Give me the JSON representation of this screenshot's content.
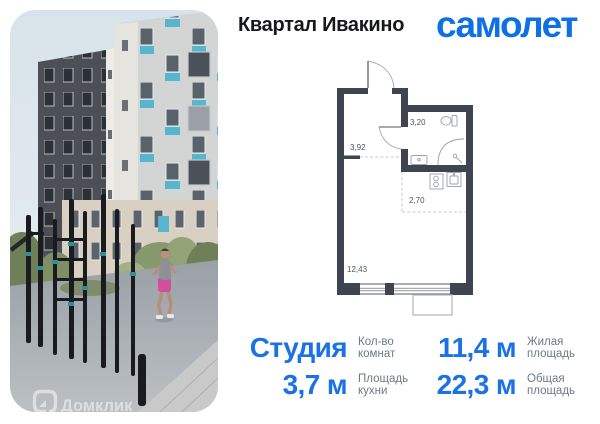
{
  "header": {
    "project_title": "Квартал Ивакино",
    "brand_logo": "самолет"
  },
  "photo": {
    "watermark": "Домклик",
    "scene": "residential towers with teal balconies, outdoor workout bars, jogging woman"
  },
  "floorplan": {
    "rooms": [
      {
        "name": "hallway",
        "area": "3,92"
      },
      {
        "name": "bathroom",
        "area": "3,20"
      },
      {
        "name": "kitchen",
        "area": "2,70"
      },
      {
        "name": "living-room",
        "area": "12,43"
      }
    ]
  },
  "details": {
    "rows": [
      {
        "value": "Студия",
        "label": "Кол-во комнат"
      },
      {
        "value": "11,4 м",
        "label": "Жилая площадь"
      },
      {
        "value": "3,7 м",
        "label": "Площадь кухни"
      },
      {
        "value": "22,3 м",
        "label": "Общая площадь"
      }
    ]
  },
  "colors": {
    "accent_blue": "#1a72e6",
    "brand_blue": "#0f70e5",
    "wall_dark": "#3e4551",
    "balcony_teal": "#55b6cd",
    "label_gray": "#6e7984"
  }
}
